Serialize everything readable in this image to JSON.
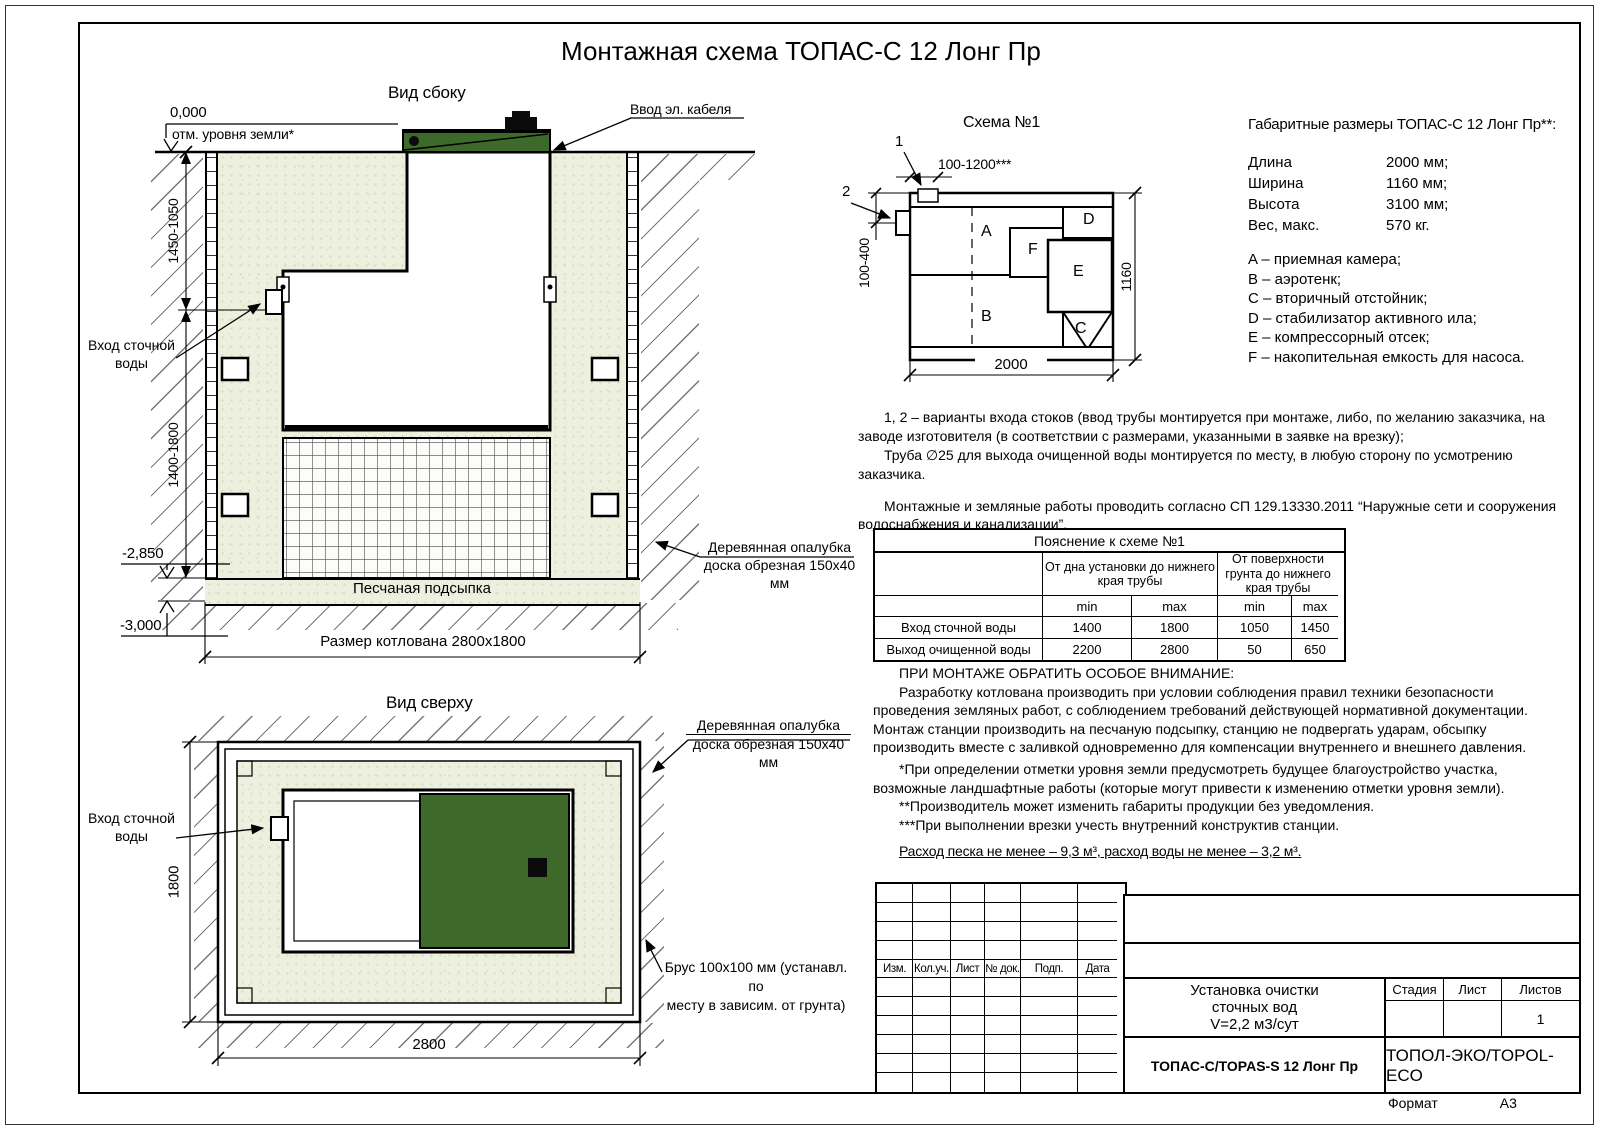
{
  "page": {
    "title": "Монтажная схема ТОПАС-С 12 Лонг Пр",
    "format_label": "Формат",
    "format_value": "А3"
  },
  "side_view": {
    "label": "Вид сбоку",
    "zero_mark": "0,000",
    "ground_note": "отм. уровня земли*",
    "dim_upper": "1450-1050",
    "dim_lower": "1400-1800",
    "mark_minus_2850": "-2,850",
    "mark_minus_3000": "-3,000",
    "inlet_line1": "Вход сточной",
    "inlet_line2": "воды",
    "cable_label": "Ввод эл. кабеля",
    "sand_label": "Песчаная подсыпка",
    "pit_dim": "Размер котлована 2800х1800",
    "formwork_line1": "Деревянная опалубка",
    "formwork_line2": "доска обрезная 150х40 мм"
  },
  "top_view": {
    "label": "Вид сверху",
    "inlet_line1": "Вход сточной",
    "inlet_line2": "воды",
    "dim_height": "1800",
    "dim_width": "2800",
    "formwork_line1": "Деревянная опалубка",
    "formwork_line2": "доска обрезная 150х40 мм",
    "beam_line1": "Брус 100х100 мм (устанавл. по",
    "beam_line2": "месту в зависим. от грунта)"
  },
  "schema": {
    "title": "Схема №1",
    "marker1": "1",
    "marker2": "2",
    "dim_top": "100-1200***",
    "dim_left": "100-400",
    "dim_bottom": "2000",
    "dim_right": "1160",
    "labels": {
      "a": "A",
      "b": "B",
      "c": "C",
      "d": "D",
      "e": "E",
      "f": "F"
    }
  },
  "specs": {
    "title": "Габаритные размеры ТОПАС-С 12 Лонг Пр**:",
    "rows": [
      {
        "label": "Длина",
        "value": "2000 мм;"
      },
      {
        "label": "Ширина",
        "value": "1160 мм;"
      },
      {
        "label": "Высота",
        "value": "3100 мм;"
      },
      {
        "label": "Вес, макс.",
        "value": "570 кг."
      }
    ],
    "legend": [
      "A – приемная камера;",
      "B – аэротенк;",
      "C – вторичный отстойник;",
      "D – стабилизатор активного ила;",
      "E – компрессорный отсек;",
      "F – накопительная емкость для насоса."
    ]
  },
  "notes": {
    "note1": "1, 2 – варианты входа  стоков (ввод трубы монтируется при монтаже, либо, по желанию заказчика, на заводе изготовителя (в соответствии с размерами, указанными в заявке на врезку);",
    "note2": "Труба ∅25 для выхода очищенной воды монтируется по месту, в любую сторону по усмотрению заказчика.",
    "note3": "Монтажные и земляные работы проводить согласно СП 129.13330.2011 “Наружные сети и сооружения водоснабжения и канализации”."
  },
  "explain_table": {
    "title": "Пояснение к схеме №1",
    "col_bottom": "От дна установки до нижнего края трубы",
    "col_surface": "От поверхности грунта до нижнего края трубы",
    "min": "min",
    "max": "max",
    "rows": [
      {
        "name": "Вход сточной воды",
        "v1": "1400",
        "v2": "1800",
        "v3": "1050",
        "v4": "1450"
      },
      {
        "name": "Выход очищенной воды",
        "v1": "2200",
        "v2": "2800",
        "v3": "50",
        "v4": "650"
      }
    ]
  },
  "attention": {
    "title": "ПРИ МОНТАЖЕ ОБРАТИТЬ ОСОБОЕ ВНИМАНИЕ:",
    "body": "Разработку котлована производить при условии соблюдения правил техники безопасности проведения земляных работ, с соблюдением требований действующей нормативной документации. Монтаж станции производить на песчаную подсыпку, станцию не подвергать ударам, обсыпку производить вместе с заливкой одновременно для компенсации внутреннего и внешнего давления.",
    "fn1": "*При определении отметки уровня земли предусмотреть будущее благоустройство участка, возможные ландшафтные работы (которые могут привести к изменению отметки уровня земли).",
    "fn2": "**Производитель может изменить габариты продукции без уведомления.",
    "fn3": "***При выполнении врезки учесть внутренний конструктив станции.",
    "consumption": "Расход песка не менее – 9,3 м³, расход воды не менее – 3,2 м³."
  },
  "title_block": {
    "rev_cols": [
      "Изм.",
      "Кол.уч.",
      "Лист",
      "№ док.",
      "Подп.",
      "Дата"
    ],
    "product_line1": "Установка очистки",
    "product_line2": "сточных вод",
    "product_line3": "V=2,2 м3/сут",
    "stage": "Стадия",
    "sheet": "Лист",
    "sheets": "Листов",
    "sheets_value": "1",
    "model": "ТОПАС-С/TOPAS-S 12 Лонг Пр",
    "company": "ТОПОЛ-ЭКО/TOPOL-ECO"
  },
  "colors": {
    "sand": "#eef0df",
    "green": "#3d692b",
    "line": "#000000"
  }
}
